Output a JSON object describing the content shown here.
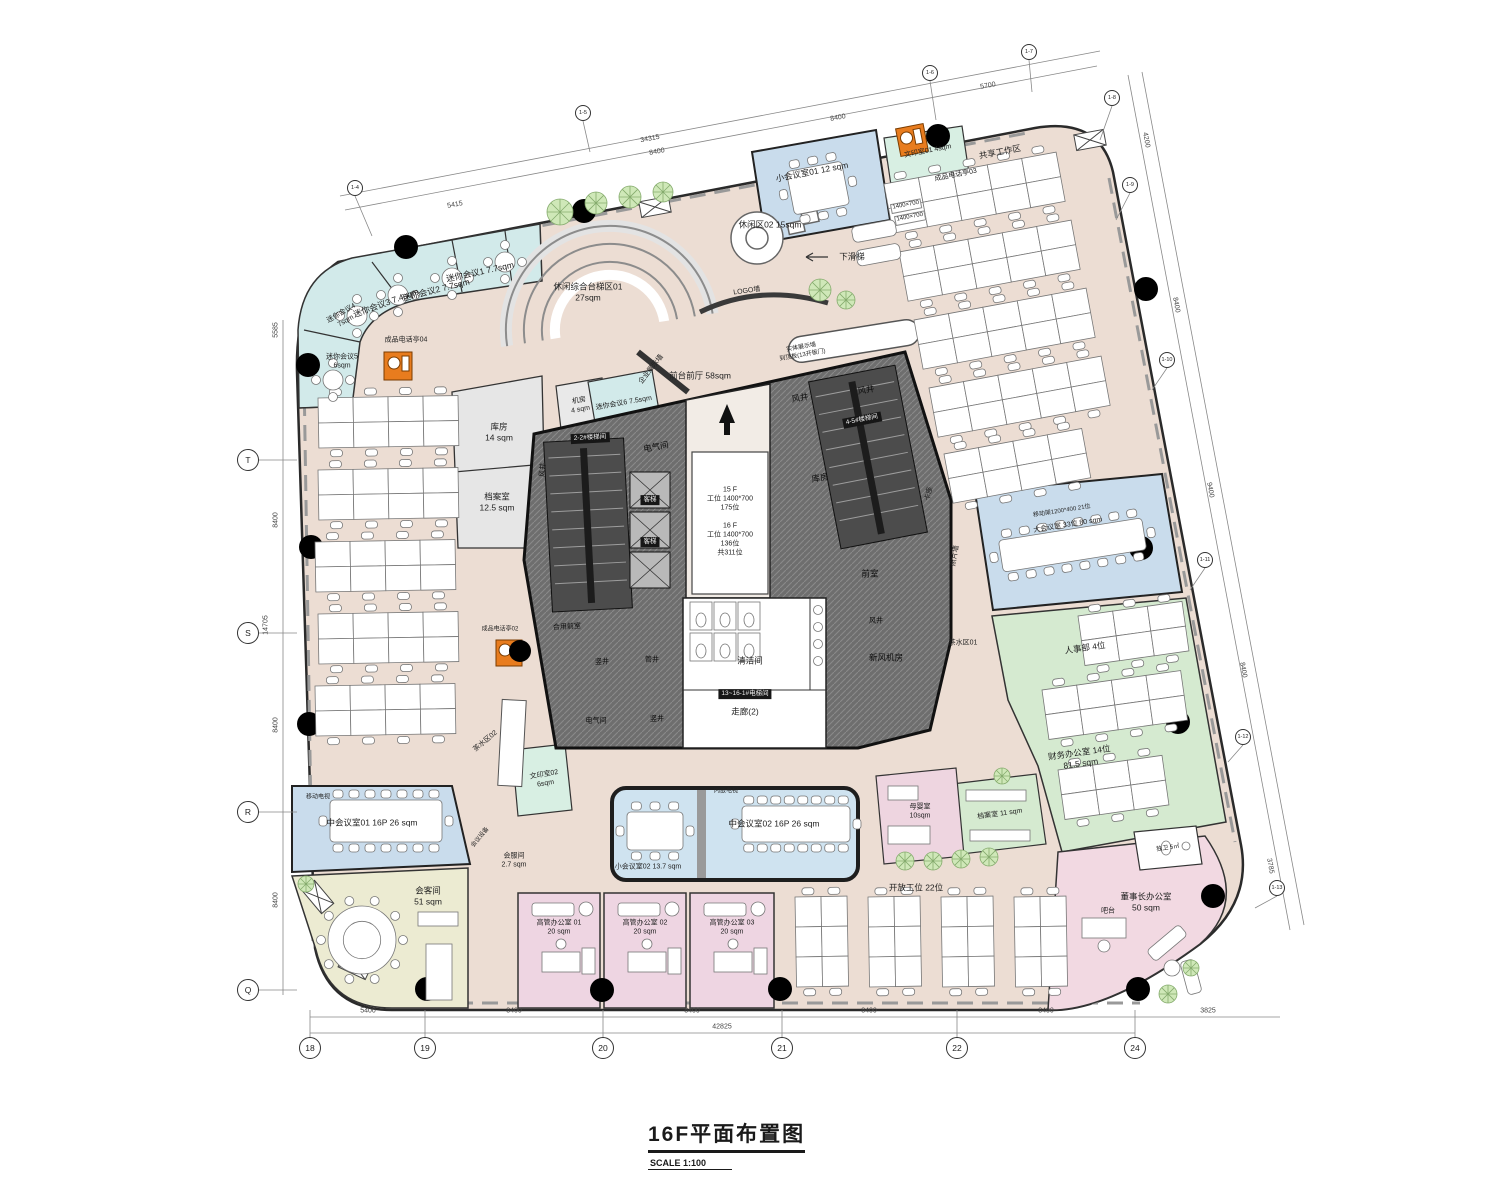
{
  "title": {
    "main": "16F平面布置图",
    "scale": "SCALE 1:100"
  },
  "core_info": {
    "a": "15 F",
    "b": "工位 1400*700",
    "c": "175位",
    "d": "16 F",
    "e": "工位 1400*700",
    "f": "136位",
    "g": "共311位"
  },
  "rooms": {
    "mini1": {
      "n": "迷你会议1",
      "a": "7.7sqm"
    },
    "mini2": {
      "n": "迷你会议2",
      "a": "7.7sqm"
    },
    "mini3": {
      "n": "迷你会议3",
      "a": "7.4sqm"
    },
    "mini4": {
      "n": "迷你会议4",
      "a": "7sqm"
    },
    "mini5": {
      "n": "迷你会议5",
      "a": "6sqm"
    },
    "mini6": {
      "n": "迷你会议6",
      "a": "7.5sqm"
    },
    "xiaohui1": {
      "n": "小会议室01 12 sqm"
    },
    "wenyin1": {
      "n": "文印室01 4sqm"
    },
    "booth02": {
      "n": "成品电话亭02"
    },
    "booth03": {
      "n": "成品电话亭03"
    },
    "booth04": {
      "n": "成品电话亭04"
    },
    "share": {
      "n": "共享工作区"
    },
    "leisure1": {
      "n": "休闲综合台梯区01",
      "a": "27sqm"
    },
    "leisure2": {
      "n": "休闲区02 15sqm"
    },
    "slide": {
      "n": "下滑梯"
    },
    "logo": {
      "n": "LOGO墙"
    },
    "reception": {
      "n": "前台前厅 58sqm"
    },
    "display": {
      "n": "企业展示墙"
    },
    "solid1": {
      "n": "实体展示墙"
    },
    "solid2": {
      "n": "到顶板(13开板门)"
    },
    "jifang": {
      "n": "机房",
      "a": "4 sqm"
    },
    "kufang1": {
      "n": "库房",
      "a": "14 sqm"
    },
    "dangan1": {
      "n": "档案室",
      "a": "12.5 sqm"
    },
    "dianqi": {
      "n": "电气间"
    },
    "fengjing": {
      "n": "风井"
    },
    "kufang2": {
      "n": "库房"
    },
    "qianshi": {
      "n": "前室"
    },
    "heyong": {
      "n": "合用前室"
    },
    "shujing": {
      "n": "竖井"
    },
    "guanjing": {
      "n": "管井"
    },
    "qingjie": {
      "n": "清洁间"
    },
    "zoulang": {
      "n": "走廊(2)"
    },
    "xinfeng": {
      "n": "新风机房"
    },
    "kazuo": {
      "n": "卡座"
    },
    "chashui1": {
      "n": "茶水区01"
    },
    "zhaopian": {
      "n": "照片墙"
    },
    "dahui_note": {
      "n": "移动架1200*400 21位"
    },
    "dahui": {
      "n": "大会议室 33位 80 sqm"
    },
    "renshi": {
      "n": "人事部 4位"
    },
    "caiwu": {
      "n": "财务办公室 14位",
      "a": "81.5 sqm"
    },
    "dangan2": {
      "n": "档案室 11 sqm"
    },
    "muying": {
      "n": "母婴室",
      "a": "10sqm"
    },
    "kaifang": {
      "n": "开放工位 22位"
    },
    "duwei": {
      "n": "独卫 5㎡"
    },
    "dongshi": {
      "n": "董事长办公室",
      "a": "50 sqm"
    },
    "batai": {
      "n": "吧台"
    },
    "gao1": {
      "n": "高管办公室 01",
      "a": "20 sqm"
    },
    "gao2": {
      "n": "高管办公室 02",
      "a": "20 sqm"
    },
    "gao3": {
      "n": "高管办公室 03",
      "a": "20 sqm"
    },
    "zhonghui1": {
      "n": "中会议室01 16P 26 sqm"
    },
    "zhonghui2": {
      "n": "中会议室02 16P 26 sqm"
    },
    "xiaohui2": {
      "n": "小会议室02 13.7 sqm"
    },
    "neiqian": {
      "n": "内嵌电视"
    },
    "yidongtv": {
      "n": "移动电视"
    },
    "huike": {
      "n": "会客间",
      "a": "51 sqm"
    },
    "huifu": {
      "n": "会服间",
      "a": "2.7 sqm"
    },
    "shebei": {
      "n": "会议设备"
    },
    "chashui2": {
      "n": "茶水区02"
    },
    "wenyin2": {
      "n": "文印室02",
      "a": "6sqm"
    },
    "desksize": {
      "n": "1400×700"
    }
  },
  "core_labels": {
    "stair1": "2-2#楼梯间",
    "stair2": "4-5#楼梯间",
    "lift": "13~16-1#电梯间",
    "car": "客梯"
  },
  "grid": {
    "left": [
      "T",
      "S",
      "R",
      "Q"
    ],
    "bottom": [
      "18",
      "19",
      "20",
      "21",
      "22",
      "24"
    ],
    "top": [
      "1-4",
      "1-5",
      "1-6",
      "1-7"
    ],
    "right": [
      "1-8",
      "1-9",
      "1-10",
      "1-11",
      "1-12",
      "1-13"
    ]
  },
  "dims": {
    "bottom": [
      "5400",
      "8400",
      "8400",
      "8400",
      "8400",
      "3825"
    ],
    "bottom_total": "42825",
    "left": [
      "5585",
      "8400",
      "14705",
      "8400",
      "8400"
    ],
    "top": [
      "5415",
      "8400",
      "8400",
      "5700"
    ],
    "top_total": "34315",
    "right": [
      "4200",
      "8400",
      "9400",
      "8400",
      "3785"
    ]
  }
}
